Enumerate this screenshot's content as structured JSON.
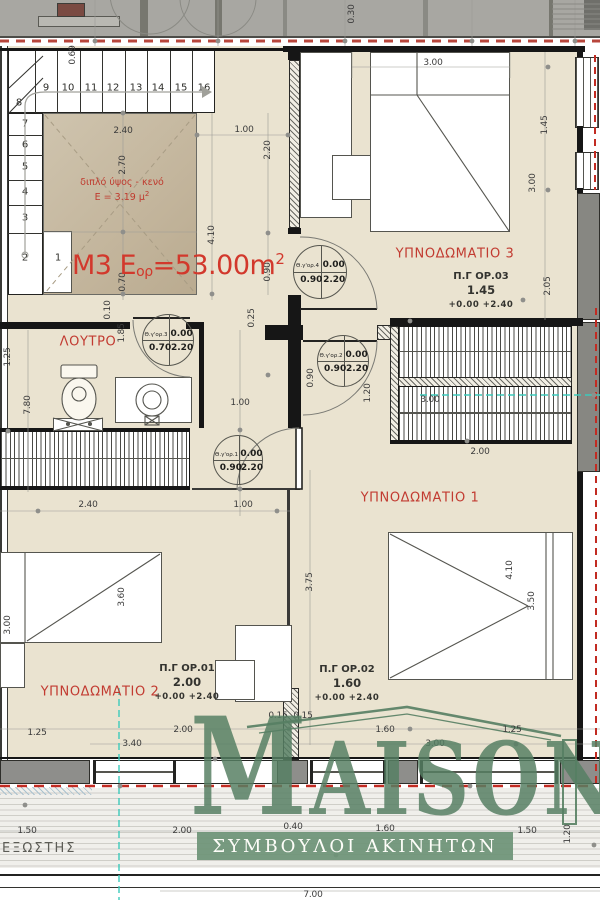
{
  "title": "Floor plan M3 - first floor apartment",
  "colors": {
    "room_fill": "#eae3d0",
    "void_fill": "#c3b59c",
    "label_red": "#c23b31",
    "area_red": "#d2382c",
    "logo_green": "#567f63",
    "boundary_red": "#c22b22",
    "axis_cyan": "#3ccabb",
    "wall_grey": "#8e8e8b"
  },
  "strip": {
    "dim_030": "0.30"
  },
  "stairs": {
    "top_row": [
      "9",
      "10",
      "11",
      "12",
      "13",
      "14",
      "15",
      "16"
    ],
    "left_col": [
      "7",
      "6",
      "5",
      "4",
      "3",
      "2"
    ],
    "corner": "8",
    "first": "1"
  },
  "void": {
    "line1": "διπλό ύψος - κενό",
    "line2": "E = 3.19 μ",
    "line2_sup": "2"
  },
  "area": {
    "prefix": "M3 E",
    "sub": "ορ",
    "mid": "=53.00m",
    "sup": "2"
  },
  "rooms": {
    "bedroom3": "ΥΠΝΟΔΩΜΑΤΙΟ 3",
    "bedroom1": "ΥΠΝΟΔΩΜΑΤΙΟ 1",
    "bedroom2": "ΥΠΝΟΔΩΜΑΤΙΟ 2",
    "bathroom": "ΛΟΥΤΡΟ",
    "balcony": "ΕΞΩΣΤΗΣ"
  },
  "windows": {
    "op03": {
      "label": "Π.Γ ΟΡ.03",
      "value": "1.45",
      "levels": "+0.00  +2.40"
    },
    "op01": {
      "label": "Π.Γ ΟΡ.01",
      "value": "2.00",
      "levels": "+0.00  +2.40"
    },
    "op02": {
      "label": "Π.Γ ΟΡ.02",
      "value": "1.60",
      "levels": "+0.00  +2.40"
    }
  },
  "doors": {
    "d4": {
      "name": "Θ.γ'ορ.4",
      "v1": "0.00",
      "v2": "0.90",
      "v3": "2.20"
    },
    "d3": {
      "name": "Θ.γ'ορ.3",
      "v1": "0.00",
      "v2": "0.70",
      "v3": "2.20"
    },
    "d2": {
      "name": "Θ.γ'ορ.2",
      "v1": "0.00",
      "v2": "0.90",
      "v3": "2.20"
    },
    "d1": {
      "name": "Θ.γ'ορ.1",
      "v1": "0.00",
      "v2": "0.90",
      "v3": "2.20"
    }
  },
  "dims": {
    "s030": "0.30",
    "s069": "0.69",
    "v240": "2.40",
    "v270": "2.70",
    "v070": "0.70",
    "h100": "1.00",
    "h220": "2.20",
    "h410": "4.10",
    "h090a": "0.90",
    "h025": "0.25",
    "h090b": "0.90",
    "h120": "1.20",
    "h100b": "1.00",
    "b3_300": "3.00",
    "b3_145": "1.45",
    "b3_300r": "3.00",
    "b3_205": "2.05",
    "ba010": "0.10",
    "ba185": "1.85",
    "ba125": "1.25",
    "ba780": "7.80",
    "w240": "2.40",
    "w100": "1.00",
    "wr300": "3.00",
    "wr200": "2.00",
    "b2_300": "3.00",
    "b2_360": "3.60",
    "b1_375": "3.75",
    "b1_410": "4.10",
    "b1_350": "3.50",
    "bt125a": "1.25",
    "bt340": "3.40",
    "bt200": "2.00",
    "bt015a": "0.15",
    "bt015b": "0.15",
    "bt160": "1.60",
    "bt300": "3.00",
    "bt125b": "1.25",
    "bl150a": "1.50",
    "bl200": "2.00",
    "bl040": "0.40",
    "bl160": "1.60",
    "bl150b": "1.50",
    "bl120": "1.20",
    "bl700": "7.00"
  },
  "logo": {
    "name_m": "M",
    "name_rest": "AISON",
    "tagline": "ΣΥΜΒΟΥΛΟΙ ΑΚΙΝΗΤΩΝ"
  }
}
